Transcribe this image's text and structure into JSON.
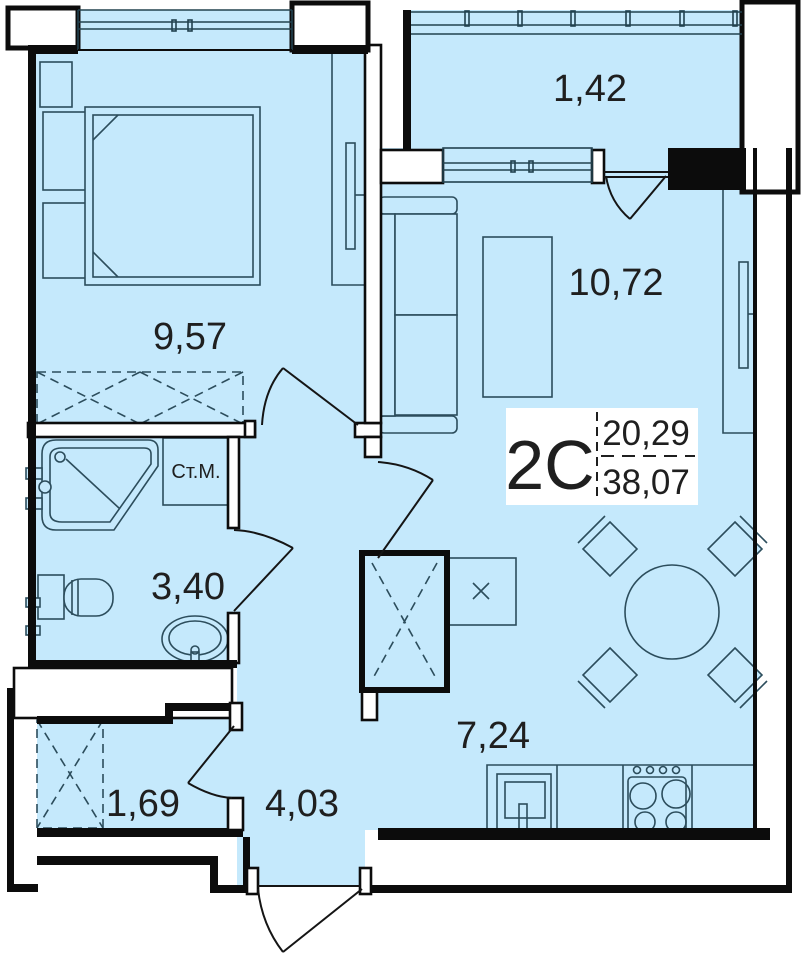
{
  "unit": {
    "label": "2С",
    "living_area": "20,29",
    "total_area": "38,07"
  },
  "rooms": {
    "bedroom": {
      "area": "9,57"
    },
    "balcony": {
      "area": "1,42"
    },
    "living_room": {
      "area": "10,72"
    },
    "bathroom": {
      "area": "3,40"
    },
    "storage": {
      "area": "1,69"
    },
    "hallway": {
      "area": "4,03"
    },
    "kitchen": {
      "area": "7,24"
    }
  },
  "annotations": {
    "washing_machine": "Ст.М."
  },
  "colors": {
    "floor": "#c5e9fc",
    "wall": "#0c0c0c",
    "furniture_line": "#2c4d5c",
    "label_text": "#1f1f1f"
  }
}
